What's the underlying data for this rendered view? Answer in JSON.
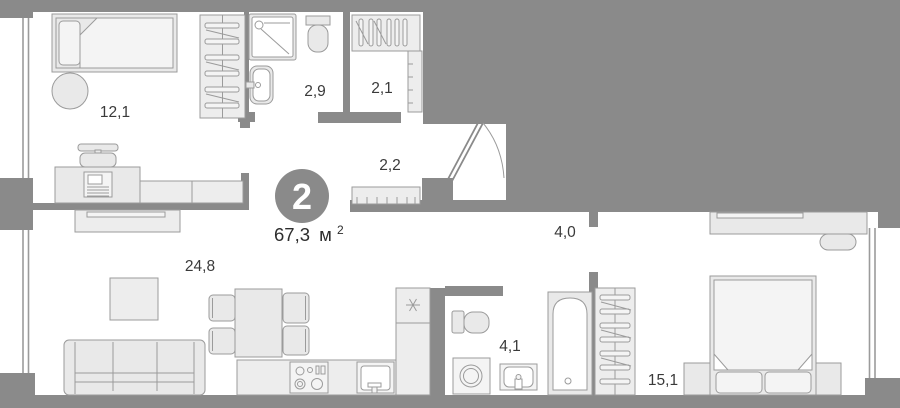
{
  "summary": {
    "room_count": "2",
    "area_value": "67,3",
    "area_unit": "м",
    "area_superscript": "2"
  },
  "rooms": [
    {
      "id": "bedroom",
      "area": "12,1"
    },
    {
      "id": "shower_room",
      "area": "2,9"
    },
    {
      "id": "wardrobe",
      "area": "2,1"
    },
    {
      "id": "hallway",
      "area": "2,2"
    },
    {
      "id": "living_kitchen",
      "area": "24,8"
    },
    {
      "id": "corridor",
      "area": "4,0"
    },
    {
      "id": "bathroom",
      "area": "4,1"
    },
    {
      "id": "bedroom_2",
      "area": "15,1"
    }
  ],
  "colors": {
    "wall": "#8a8a8a",
    "furniture_fill": "#e9e9e9",
    "furniture_stroke": "#9b9b9b",
    "label_text": "#3a3a3a",
    "badge_fill": "#8a8a8a",
    "badge_text": "#ffffff",
    "background": "#ffffff"
  }
}
